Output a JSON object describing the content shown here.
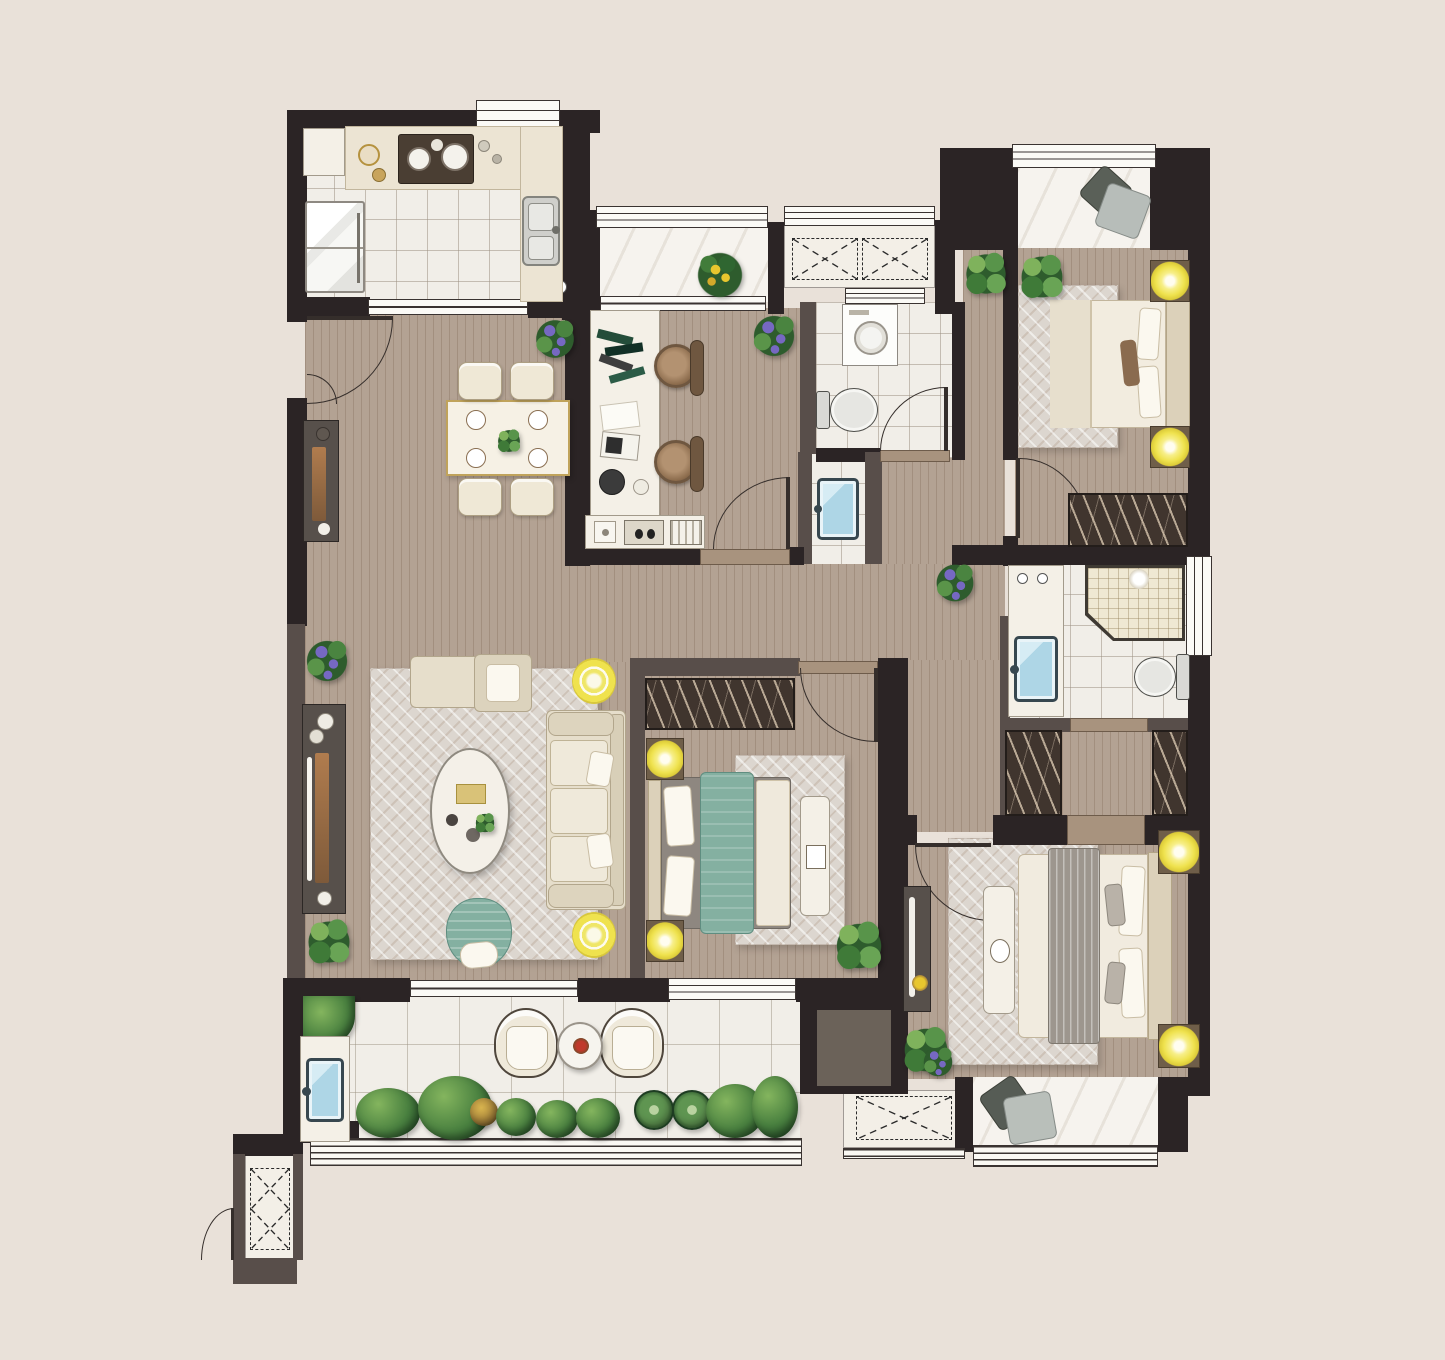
{
  "title": "apartment-floor-plan",
  "visible_text": [],
  "palette": {
    "bg": "#e9e1d9",
    "wallDark": "#2b2425",
    "wallBrown": "#584e4a",
    "shaftGray": "#6b6259",
    "wood": "#b3a293",
    "tile": "#f1eee8",
    "marble": "#f6f3ee",
    "platform": "#f3efe7",
    "rug": "#dcd6cf",
    "teal": "#84b0a1",
    "lampYellow": "#efe24e",
    "nightstand": "#6f5e49",
    "plantDark": "#2e5c2d",
    "flowerPurple": "#7668c2",
    "sinkBlue": "#aed6e6",
    "sillTan": "#a8937e",
    "wardrobe": "#40352e",
    "beige": "#e6decb",
    "furnWhite": "#f4f0e7",
    "grayFurn": "#57504b",
    "winLine": "#3a3331",
    "blanketGray": "#9d968e",
    "headboard": "#dcd1ba"
  },
  "rooms": [
    {
      "id": "kitchen",
      "floor": "tile",
      "features": [
        "upper-cabinet",
        "counter",
        "cooktop-2-burner",
        "double-basin-sink",
        "refrigerator",
        "window",
        "sliding-door"
      ]
    },
    {
      "id": "dining-area",
      "floor": "wood",
      "features": [
        "dining-table",
        "dining-chair-x4",
        "sideboard",
        "double-entry-door",
        "plant"
      ]
    },
    {
      "id": "study",
      "floor": "wood",
      "features": [
        "desk",
        "task-chair-x2",
        "low-cabinet",
        "swing-door",
        "plant"
      ]
    },
    {
      "id": "north-balcony",
      "floor": "marble",
      "features": [
        "flower-pot",
        "window",
        "sliding-door"
      ]
    },
    {
      "id": "equipment-platform-north",
      "floor": "platform",
      "features": [
        "ac-unit-x2-dashed-x"
      ]
    },
    {
      "id": "bathroom",
      "floor": "tile",
      "features": [
        "washing-machine",
        "toilet",
        "swing-door",
        "transom-window"
      ]
    },
    {
      "id": "wash-basin-nook",
      "floor": "tile",
      "features": [
        "basin"
      ]
    },
    {
      "id": "bedroom-north",
      "floor": "wood",
      "features": [
        "double-bed",
        "bedside-lamp-x2",
        "rug",
        "wardrobe",
        "bay-window-with-cushions",
        "swing-door",
        "plant"
      ]
    },
    {
      "id": "living-room",
      "floor": "wood",
      "features": [
        "sofa",
        "lounge-chaise",
        "oval-coffee-table",
        "tv-console",
        "accent-armchair",
        "floor-lamp-x2",
        "rug",
        "plant-x2",
        "sliding-door-to-balcony"
      ]
    },
    {
      "id": "hallway",
      "floor": "wood",
      "features": [
        "plant"
      ]
    },
    {
      "id": "bedroom-middle",
      "floor": "wood",
      "features": [
        "double-bed-teal-runner",
        "bedside-lamp-x2",
        "bench",
        "rug",
        "wardrobe",
        "swing-door",
        "window",
        "plant"
      ]
    },
    {
      "id": "master-bathroom",
      "floor": "tile",
      "features": [
        "vanity-basin",
        "corner-shower",
        "toilet",
        "window"
      ]
    },
    {
      "id": "walk-in-closet",
      "floor": "wood",
      "features": [
        "wardrobe-left",
        "wardrobe-right"
      ]
    },
    {
      "id": "master-bedroom",
      "floor": "wood",
      "features": [
        "double-bed-gray-throw",
        "bedside-lamp-x2",
        "bench-with-tray",
        "rug",
        "tv-console",
        "bay-window-with-cushions",
        "swing-door",
        "plant-x2"
      ]
    },
    {
      "id": "south-balcony",
      "floor": "tile",
      "features": [
        "outdoor-chair-x2",
        "round-side-table",
        "planting-bed",
        "wash-basin",
        "railing",
        "sliding-door"
      ]
    },
    {
      "id": "equipment-platform-south",
      "floor": "platform",
      "features": [
        "ac-unit-dashed-x"
      ]
    },
    {
      "id": "utility-niche-southwest",
      "floor": "platform",
      "features": [
        "equipment-dashed-x",
        "swing-door"
      ]
    }
  ],
  "counts": {
    "bedrooms": 3,
    "bathrooms": 2,
    "balconies": 3,
    "swing_doors": 7,
    "equipment_platforms": 3
  }
}
